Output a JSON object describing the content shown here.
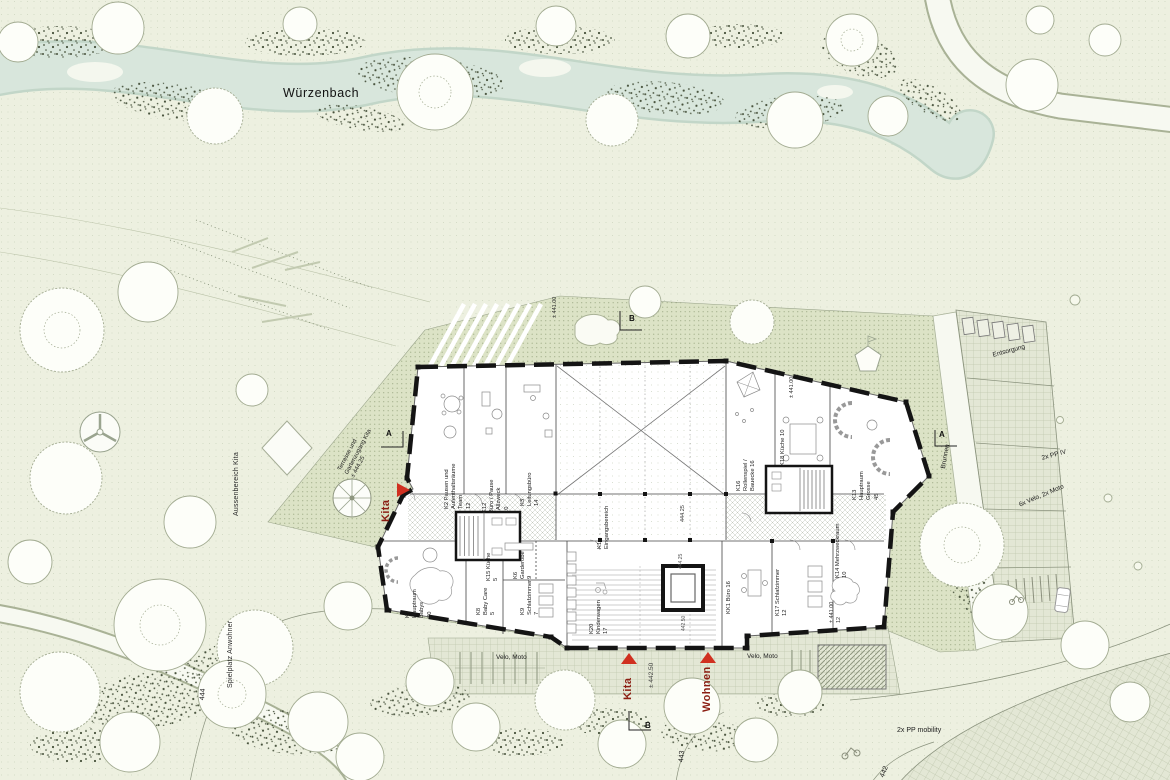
{
  "site": {
    "stream_label": "Würzenbach",
    "areas": {
      "aussenbereich": "Aussenbereich Kita",
      "spielplatz": "Spielplatz Anwohner",
      "terrasse": "Terrasse und\nGartenzugang Kita\n± 444.25"
    },
    "landmarks": {
      "brunnen": "Brunnen"
    },
    "parking": {
      "entsorgung": "Entsorgung",
      "pp_iv": "2x PP IV",
      "velo_moto_6x": "6x Velo, 2x Moto",
      "pp_mobility": "2x PP mobility",
      "velo_moto_west": "Velo, Moto",
      "velo_moto_east": "Velo, Moto"
    },
    "entrances": {
      "kita_west": "Kita",
      "kita_south": "Kita",
      "wohnen_south": "Wohnen"
    },
    "elevations": {
      "south_court": "± 442.50",
      "terrace_nw": "± 441.00",
      "terrace_ne": "± 441.00"
    },
    "contours": {
      "c444": "444",
      "c443": "443",
      "c442": "442"
    },
    "sections": {
      "a_west": "A",
      "a_east": "A",
      "b_north": "B",
      "b_south": "B"
    }
  },
  "building": {
    "elevations": {
      "hall": "444.25",
      "stair_upper": "444.25",
      "stair_lower": "442.50",
      "k14_terrace": "± 441.00\n12"
    },
    "rooms": {
      "k1": "K1\nEingangsbereich",
      "k2": "K2 Pausen und\nAufenthaltsräume\nTeam\n12",
      "k3": "K3\nLeitungsbüro\n14",
      "k6": "K6\nGarderobe\n9",
      "k7": "K7\nHauptraum\nBabys\n30",
      "k8": "K8\nBaby Care\n5",
      "k9": "K9\nSchlafzimmer\n7",
      "k12": "K12\nBüro / Pause\n/ Allzweck\n10",
      "k13": "K13\nHauptraum\nGrosse\n45",
      "k14": "K14 Mehrzweckraum\n10",
      "k15": "K15 Küche\n5",
      "k16": "K16\nRollenspiel /\nBauecke 16",
      "k17": "K17 Schlafzimmer\n12",
      "k18": "K18 Küche 10",
      "k20": "K20\nKinderwagen\n17",
      "kk1": "KK1 Büro 16"
    }
  },
  "colors": {
    "background": "#edf0e0",
    "water": "#d8e6dc",
    "terrace": "#dce3c6",
    "pavement": "#e3e7d5",
    "wall": "#141414",
    "accent_red": "#d03020",
    "label_red": "#8b1d12",
    "tree_outline": "#a2ab91",
    "vegetation": "#46513b"
  }
}
